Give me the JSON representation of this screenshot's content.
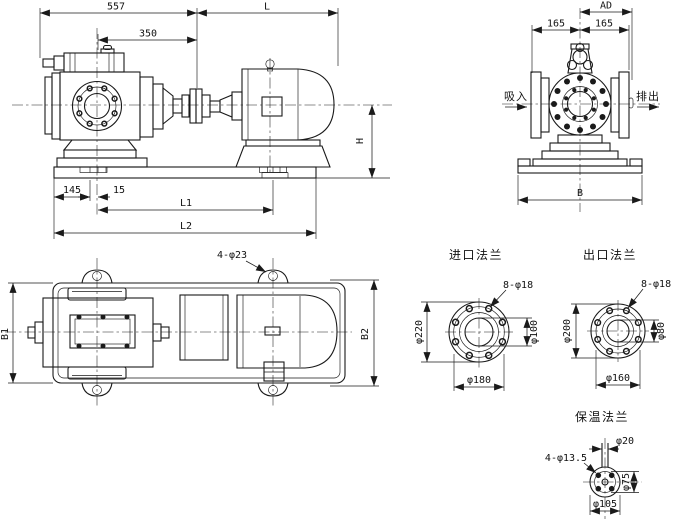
{
  "colors": {
    "line": "#1a1a1a",
    "background": "#ffffff"
  },
  "views": {
    "side": {
      "d557": "557",
      "dL": "L",
      "d350": "350",
      "dH": "H",
      "d145": "145",
      "d15": "15",
      "dL1": "L1",
      "dL2": "L2"
    },
    "end": {
      "dAD": "AD",
      "d165_left": "165",
      "d165_right": "165",
      "suction": "吸入",
      "discharge": "排出",
      "dB": "B"
    },
    "plan": {
      "bolt_note": "4-φ23",
      "dB1": "B1",
      "dB2": "B2"
    },
    "inlet_flange": {
      "title": "进口法兰",
      "bolt_note": "8-φ18",
      "d_outer": "φ220",
      "d_bore": "φ100",
      "d_bolt_circle": "φ180"
    },
    "outlet_flange": {
      "title": "出口法兰",
      "bolt_note": "8-φ18",
      "d_outer": "φ200",
      "d_bore": "φ80",
      "d_bolt_circle": "φ160"
    },
    "insulation_flange": {
      "title": "保温法兰",
      "d_pipe": "φ20",
      "bolt_note": "4-φ13.5",
      "d_inner": "φ75",
      "d_bolt_circle": "φ105"
    }
  }
}
